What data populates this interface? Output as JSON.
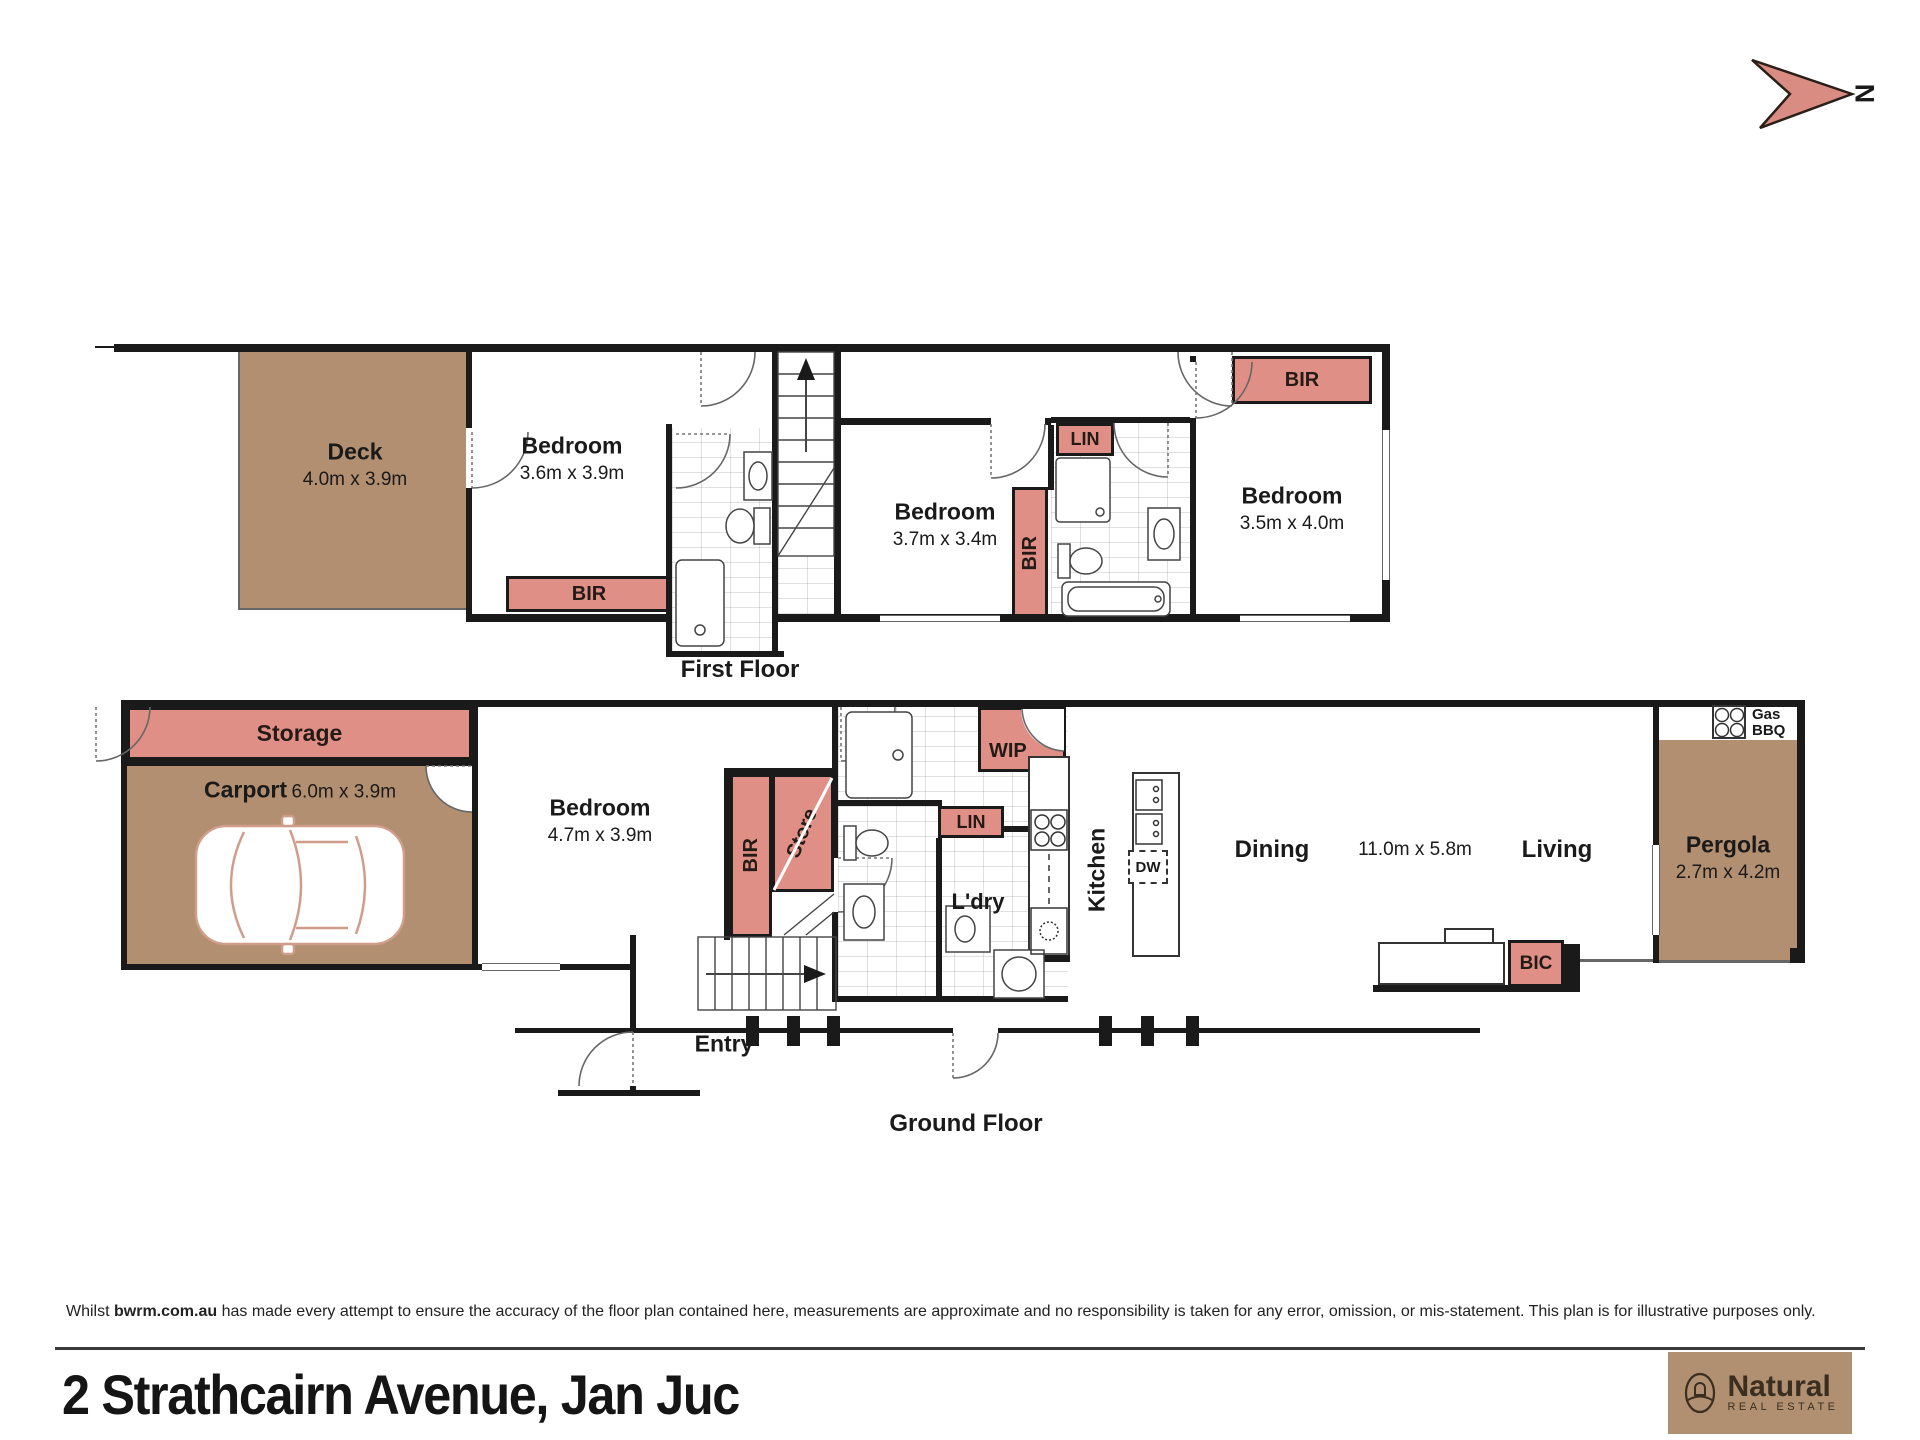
{
  "north": {
    "label": "N"
  },
  "ff": {
    "title": "First Floor",
    "deck": "Deck",
    "deck_dims": "4.0m x 3.9m",
    "bed1": "Bedroom",
    "bed1_dims": "3.6m x 3.9m",
    "bed2": "Bedroom",
    "bed2_dims": "3.7m x 3.4m",
    "bed3": "Bedroom",
    "bed3_dims": "3.5m x 4.0m",
    "bir1": "BIR",
    "bir2": "BIR",
    "bir3": "BIR",
    "lin": "LIN"
  },
  "gf": {
    "title": "Ground Floor",
    "storage": "Storage",
    "carport": "Carport",
    "carport_dims": "6.0m x 3.9m",
    "bedroom": "Bedroom",
    "bedroom_dims": "4.7m x 3.9m",
    "entry": "Entry",
    "bir": "BIR",
    "store": "Store",
    "lin": "LIN",
    "wip": "WIP",
    "ldry": "L'dry",
    "kitchen": "Kitchen",
    "dw": "DW",
    "dining": "Dining",
    "open_dims": "11.0m x 5.8m",
    "living": "Living",
    "bic": "BIC",
    "pergola": "Pergola",
    "pergola_dims": "2.7m x 4.2m",
    "gas": "Gas",
    "bbq": "BBQ"
  },
  "footer": {
    "disclaimer_prefix": "Whilst ",
    "disclaimer_brand": "bwrm.com.au",
    "disclaimer_rest": " has made every attempt to ensure the accuracy of the floor plan contained here, measurements are approximate and no responsibility is taken for any error, omission, or mis-statement. This plan is for illustrative purposes only.",
    "address": "2 Strathcairn Avenue, Jan Juc",
    "logo_name": "Natural",
    "logo_sub": "REAL ESTATE"
  },
  "colors": {
    "accent": "#df8f85",
    "wood": "#b28f70",
    "wall": "#1a1a1a",
    "logo_bg": "#b09070"
  }
}
